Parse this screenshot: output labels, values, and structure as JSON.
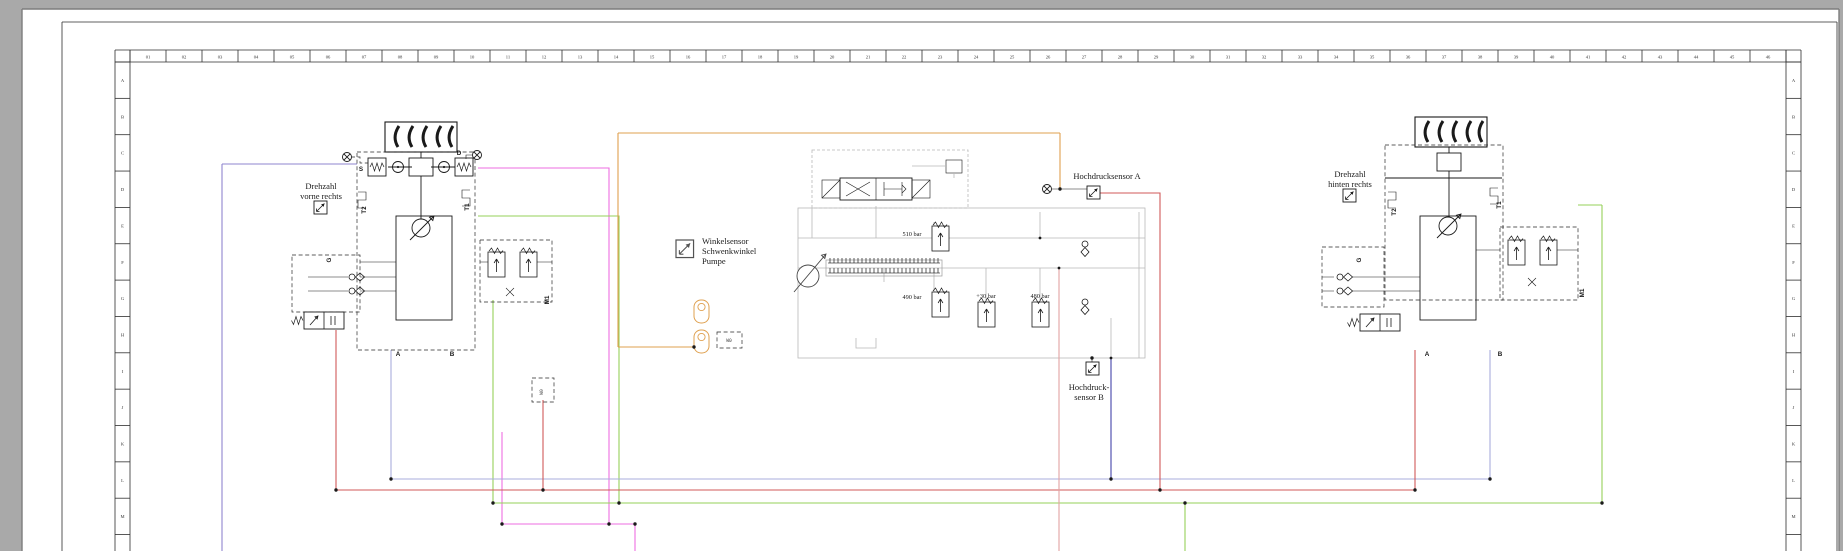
{
  "window": {
    "bg": "#a9a9a9",
    "page": "#ffffff"
  },
  "frame": {
    "columns": [
      "01",
      "02",
      "03",
      "04",
      "05",
      "06",
      "07",
      "08",
      "09",
      "10",
      "11",
      "12",
      "13",
      "14",
      "15",
      "16",
      "17",
      "18",
      "19",
      "20",
      "21",
      "22",
      "23",
      "24",
      "25",
      "26",
      "27",
      "28",
      "29",
      "30",
      "31",
      "32",
      "33",
      "34",
      "35",
      "36",
      "37",
      "38",
      "39",
      "40",
      "41",
      "42",
      "43",
      "44",
      "45",
      "46"
    ],
    "rows": [
      "A",
      "B",
      "C",
      "D",
      "E",
      "F",
      "G",
      "H",
      "I",
      "J",
      "K",
      "L",
      "M",
      "N"
    ]
  },
  "left_assembly": {
    "label_line1": "Drehzahl",
    "label_line2": "vorne rechts",
    "port_s": "S",
    "port_d": "D",
    "port_t2": "T2",
    "port_t1": "T1",
    "port_g": "G",
    "port_a": "A",
    "port_b": "B",
    "port_m1": "M1"
  },
  "right_assembly": {
    "label_line1": "Drehzahl",
    "label_line2": "hinten rechts",
    "port_t2": "T2",
    "port_t1": "T1",
    "port_g": "G",
    "port_a": "A",
    "port_b": "B",
    "port_m1": "M1"
  },
  "pump": {
    "label_line1": "Winkelsensor",
    "label_line2": "Schwenkwinkel",
    "label_line3": "Pumpe",
    "pressure_510": "510 bar",
    "pressure_490": "490 bar",
    "pressure_30": "+30 bar",
    "pressure_480": "480 bar",
    "tag_w0": "W0",
    "tag_w": "W0"
  },
  "sensors": {
    "hp_a": "Hochdrucksensor A",
    "hp_b_line1": "Hochdruck-",
    "hp_b_line2": "sensor B"
  },
  "colors": {
    "violet": "#8f86cf",
    "magenta": "#ee6ee2",
    "red": "#d05a5a",
    "salmon": "#e2a3a3",
    "periwinkle": "#a9aedd",
    "blue": "#4343aa",
    "green": "#96d05a",
    "orange": "#dfa04f",
    "schematic_gray": "#b9b9b9",
    "ink": "#1a1a1a"
  }
}
